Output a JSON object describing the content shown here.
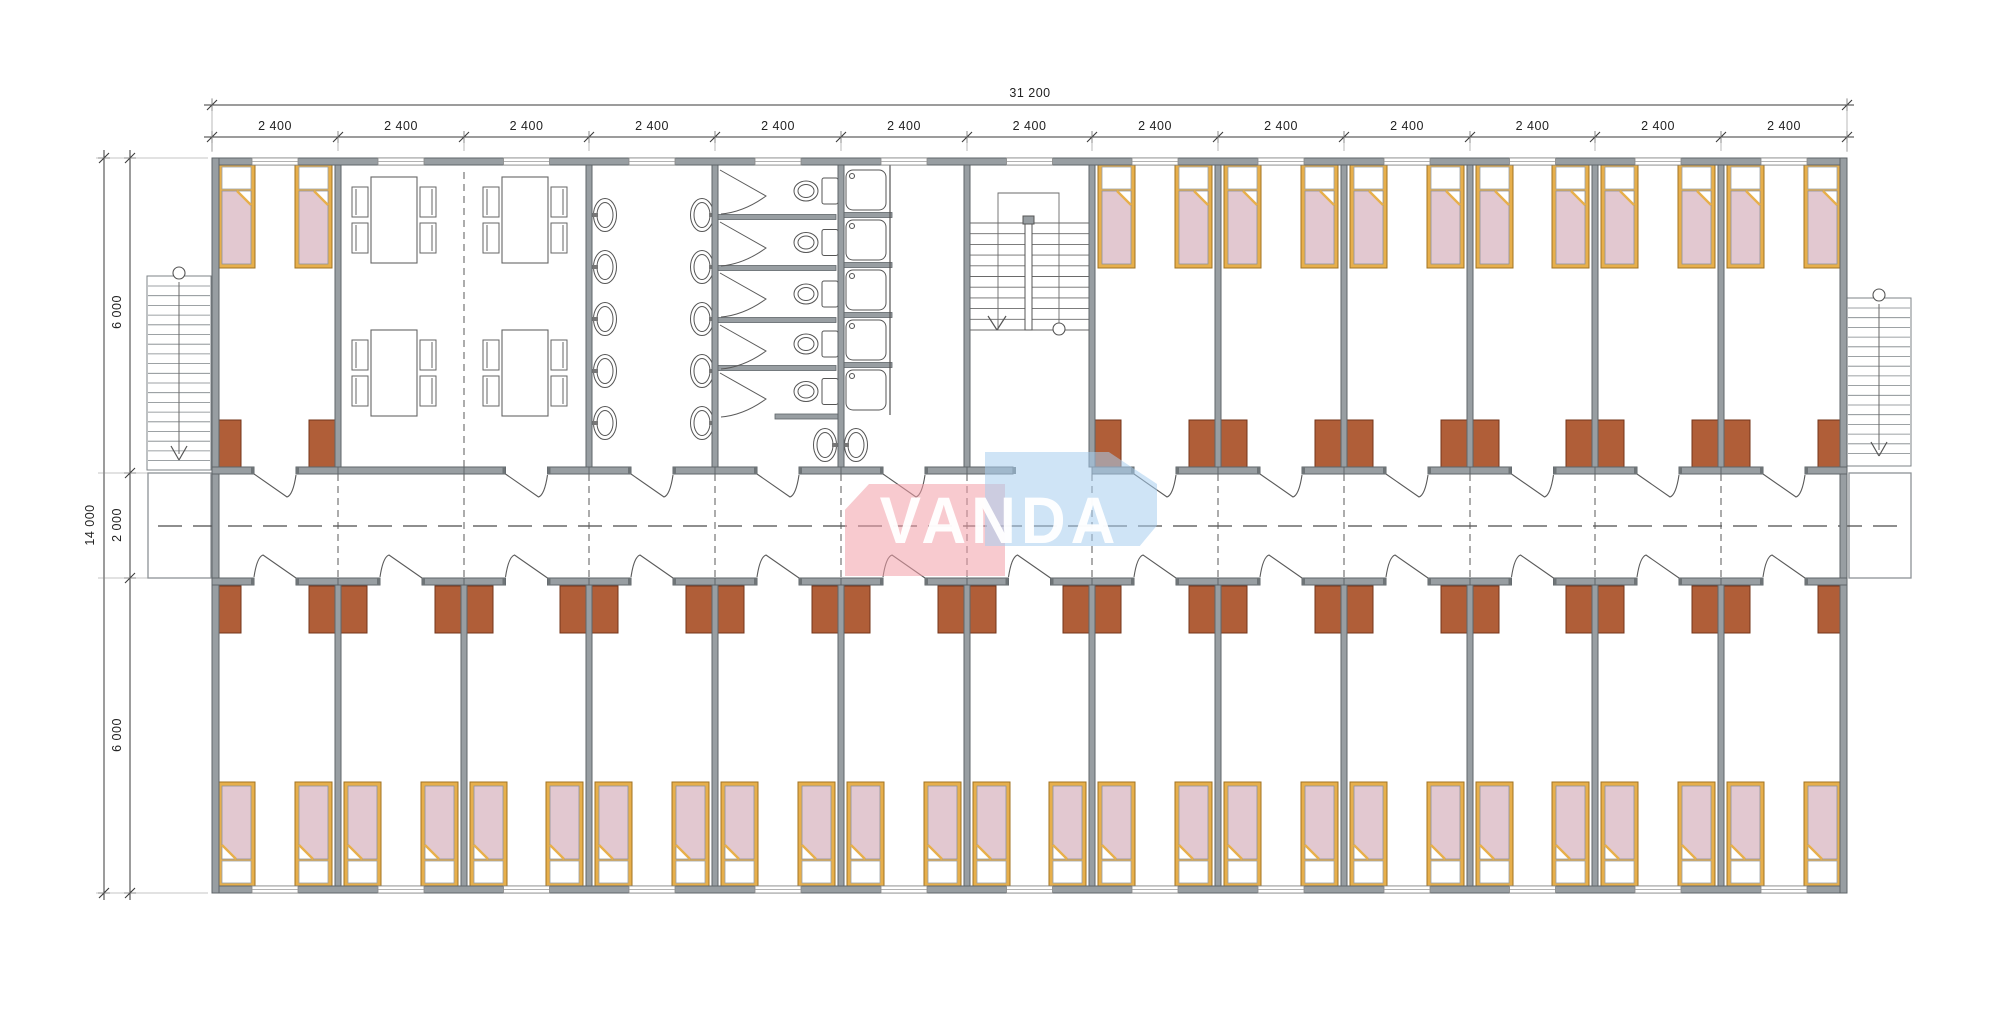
{
  "plan": {
    "type": "dormitory-floor-plan"
  },
  "dimensions": {
    "overall_width": "31 200",
    "overall_height": "14 000",
    "bays": [
      "2 400",
      "2 400",
      "2 400",
      "2 400",
      "2 400",
      "2 400",
      "2 400",
      "2 400",
      "2 400",
      "2 400",
      "2 400",
      "2 400",
      "2 400"
    ],
    "height_segments": [
      "6 000",
      "2 000",
      "6 000"
    ]
  },
  "watermark": {
    "text": "VANDA",
    "pink_color": "rgba(242,158,168,0.55)",
    "blue_color": "rgba(168,206,238,0.55)",
    "text_color": "rgba(255,255,255,0.95)"
  },
  "colors": {
    "wall_fill": "#989ea2",
    "wall_stroke": "#5f6569",
    "jamb": "#6e7477",
    "line": "#5a5a5a",
    "stair_line": "#6a6a6a",
    "dim_line": "#3a3a3a",
    "ext_line": "#8a8a8a",
    "text": "#222222",
    "bed_frame": "#e7af4b",
    "bed_frame_stroke": "#a07323",
    "bed_blanket": "#e2c8d0",
    "bed_blanket_stroke": "#8f939a",
    "pillow_stroke": "#9aa0a6",
    "cabinet_fill": "#b05e38",
    "cabinet_stroke": "#73341a",
    "fixture_stroke": "#555555",
    "furniture_stroke": "#666666"
  },
  "inventory": {
    "bays": 13,
    "beds_top_wing": 14,
    "beds_bottom_wing": 26,
    "dining_tables": 4,
    "chairs_per_table": 4,
    "wash_basins_per_side": 5,
    "vestibule_basins": 2,
    "toilet_stalls": 5,
    "shower_stalls": 5,
    "internal_staircases": 1,
    "external_staircases": 2
  }
}
